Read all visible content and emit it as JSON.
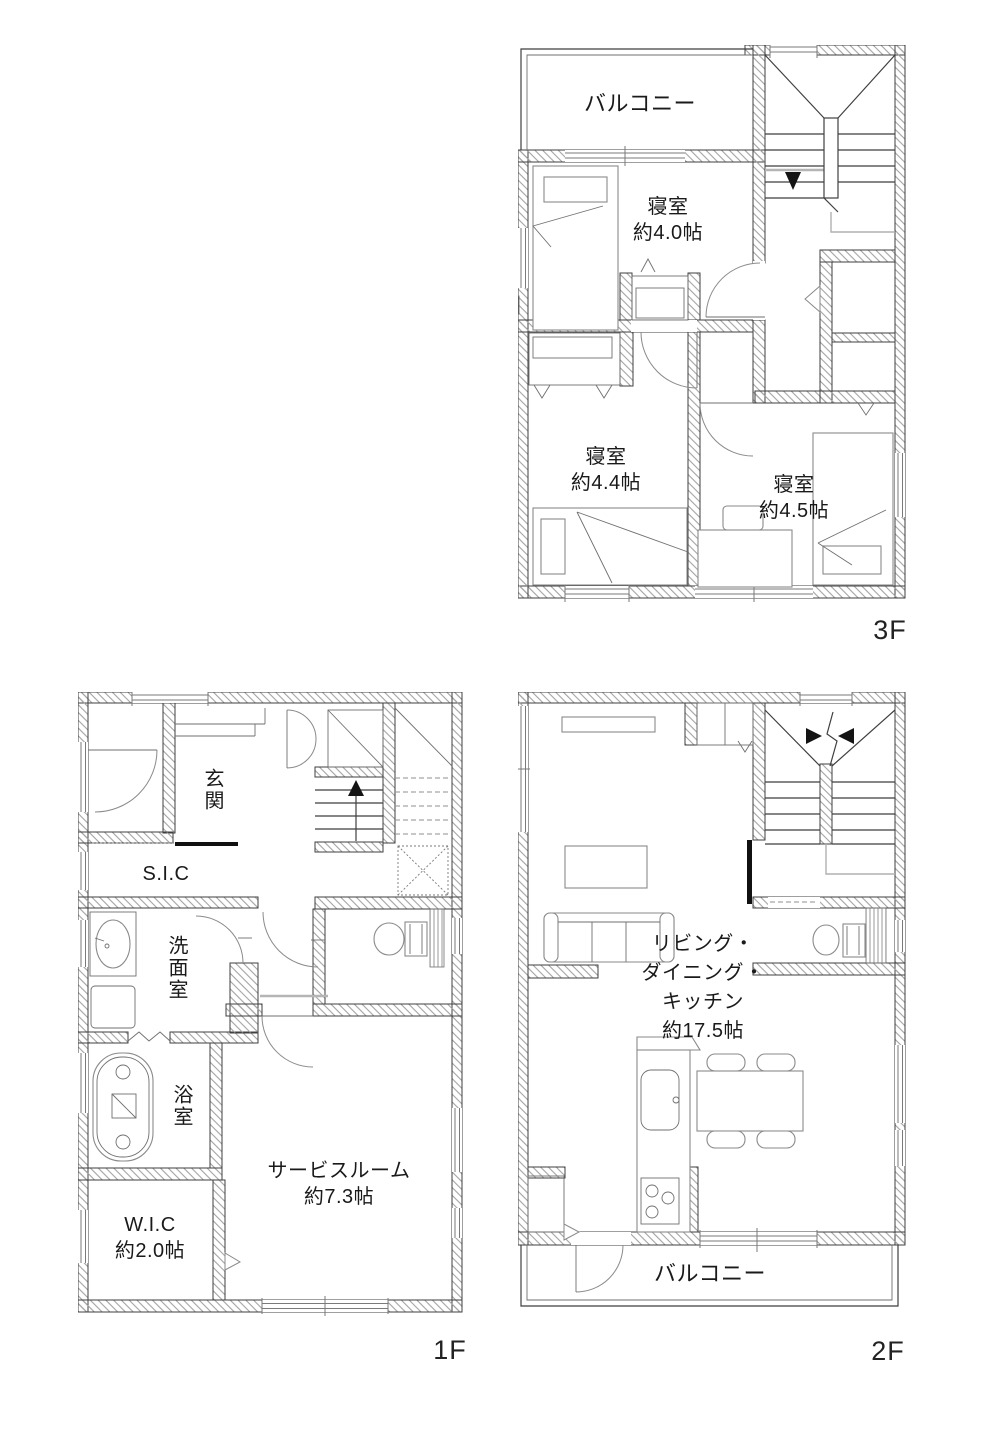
{
  "document": {
    "type": "floor-plan",
    "background": "#ffffff"
  },
  "colors": {
    "wall_line": "#3f3f3f",
    "hatch": "#a3a3a3",
    "furniture": "#8a8a8a",
    "arrow": "#141414",
    "text": "#1a1a1a"
  },
  "floors": {
    "f3": {
      "floor_label": "3F",
      "balcony": "バルコニー",
      "bedroom_a_name": "寝室",
      "bedroom_a_size": "約4.0帖",
      "bedroom_b_name": "寝室",
      "bedroom_b_size": "約4.4帖",
      "bedroom_c_name": "寝室",
      "bedroom_c_size": "約4.5帖"
    },
    "f1": {
      "floor_label": "1F",
      "entrance": "玄関",
      "shoes_closet": "S.I.C",
      "washroom": "洗面室",
      "bathroom": "浴室",
      "service_room_name": "サービスルーム",
      "service_room_size": "約7.3帖",
      "wic_name": "W.I.C",
      "wic_size": "約2.0帖"
    },
    "f2": {
      "floor_label": "2F",
      "ldk_line1": "リビング・",
      "ldk_line2": "ダイニング・",
      "ldk_line3": "キッチン",
      "ldk_size": "約17.5帖",
      "balcony": "バルコニー"
    }
  }
}
